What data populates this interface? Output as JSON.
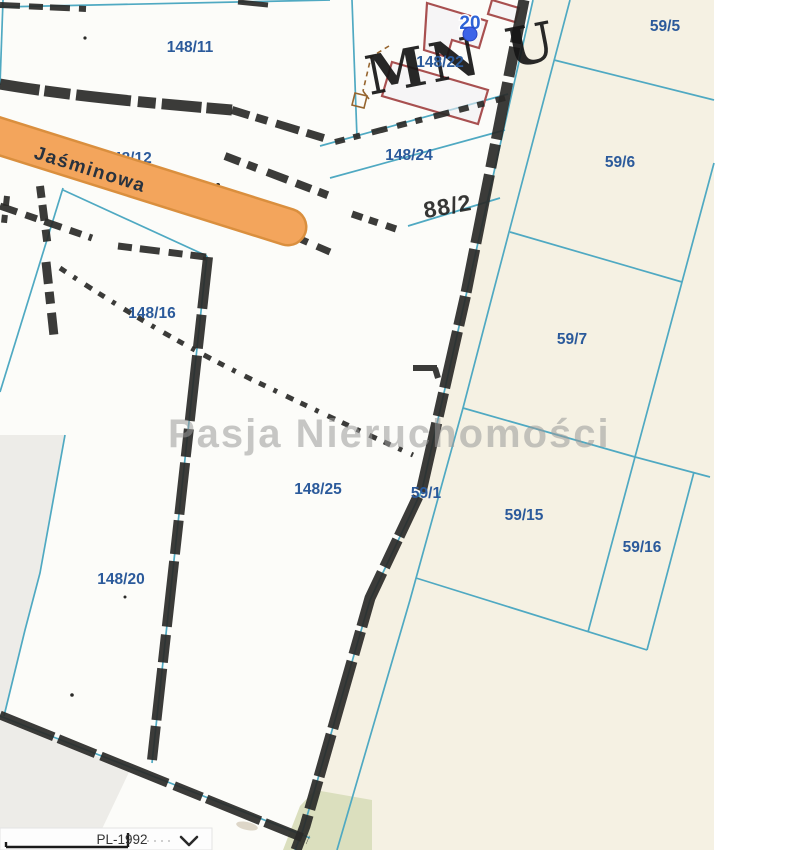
{
  "colors": {
    "parcel-line": "#4fa9c2",
    "parcel-label": "#2b5a9b",
    "road-fill": "#f3a55c",
    "road-border": "#da8f3e",
    "marker-blue": "#3c63e8",
    "marker-label": "#2e63d6",
    "building-red": "#a85050",
    "scan-black": "#2a2a28",
    "beige": "#f5f1e3",
    "green": "#dbdfbe",
    "watermark": "#9a9a9a",
    "util-brown": "#96652f"
  },
  "map": {
    "watermark": "Pasja Nieruchomości",
    "street": {
      "label": "Jaśminowa"
    },
    "zoning": {
      "label": "MN U"
    },
    "scan_text": {
      "label": "88/2"
    },
    "marker": {
      "label": "20"
    },
    "parcels": {
      "p148_11": "148/11",
      "p148_12": "148/12",
      "p148_16": "148/16",
      "p148_20": "148/20",
      "p148_22": "148/22",
      "p148_24": "148/24",
      "p148_25": "148/25",
      "p59_1": "59/1",
      "p59_5": "59/5",
      "p59_6": "59/6",
      "p59_7": "59/7",
      "p59_15": "59/15",
      "p59_16": "59/16"
    }
  },
  "bottom_bar": {
    "projection_label": "PL-1992"
  }
}
